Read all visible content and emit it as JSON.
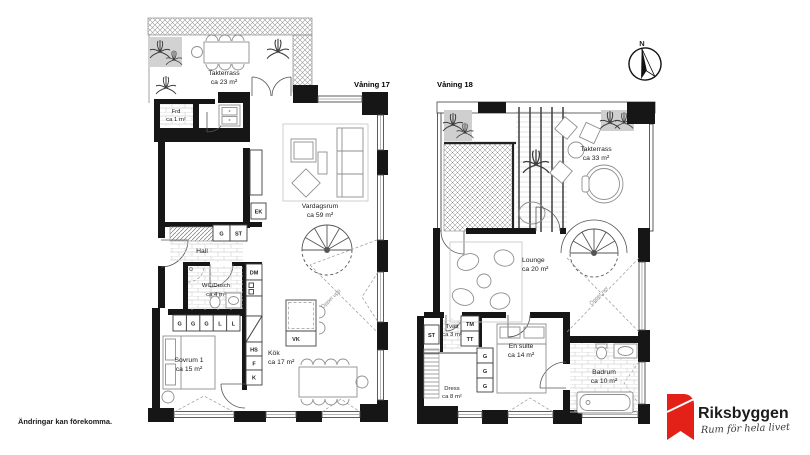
{
  "colors": {
    "wall": "#161616",
    "brand_red": "#e32119",
    "brand_gray": "#97999c"
  },
  "compass": {
    "label": "N"
  },
  "footer": {
    "disclaimer": "Ändringar kan förekomma."
  },
  "logo": {
    "brand": "Riksbyggen",
    "tagline": "Rum för hela livet"
  },
  "floor17": {
    "label": "Våning 17",
    "open_note": "Öppet upp",
    "rooms": {
      "takterrass": {
        "name": "Takterrass",
        "area": "ca 23 m²"
      },
      "frd": {
        "name": "Frd",
        "area": "ca 1 m²"
      },
      "vardagsrum": {
        "name": "Vardagsrum",
        "area": "ca 59 m²"
      },
      "hall": {
        "name": "Hall"
      },
      "wc_dusch": {
        "name": "WC/Dusch",
        "area": "ca 4 m²"
      },
      "sovrum1": {
        "name": "Sovrum 1",
        "area": "ca 15 m²"
      },
      "kok": {
        "name": "Kök",
        "area": "ca 17 m²"
      }
    },
    "fixtures": {
      "ek": "EK",
      "g": "G",
      "st": "ST",
      "dm": "DM",
      "hs": "HS",
      "f": "F",
      "k": "K",
      "vk": "VK"
    },
    "closet_row": [
      "G",
      "G",
      "G",
      "L",
      "L"
    ]
  },
  "floor18": {
    "label": "Våning 18",
    "open_note": "Öppet ner",
    "rooms": {
      "takterrass": {
        "name": "Takterrass",
        "area": "ca 33 m²"
      },
      "lounge": {
        "name": "Lounge",
        "area": "ca 20 m²"
      },
      "tvatt": {
        "name": "Tvätt",
        "area": "ca 3 m²"
      },
      "dress": {
        "name": "Dress",
        "area": "ca 8 m²"
      },
      "en_suite": {
        "name": "En suite",
        "area": "ca 14 m²"
      },
      "badrum": {
        "name": "Badrum",
        "area": "ca 10 m²"
      }
    },
    "fixtures": {
      "st": "ST",
      "tm": "TM",
      "tt": "TT"
    },
    "wardrobes": [
      "G",
      "G",
      "G"
    ]
  }
}
